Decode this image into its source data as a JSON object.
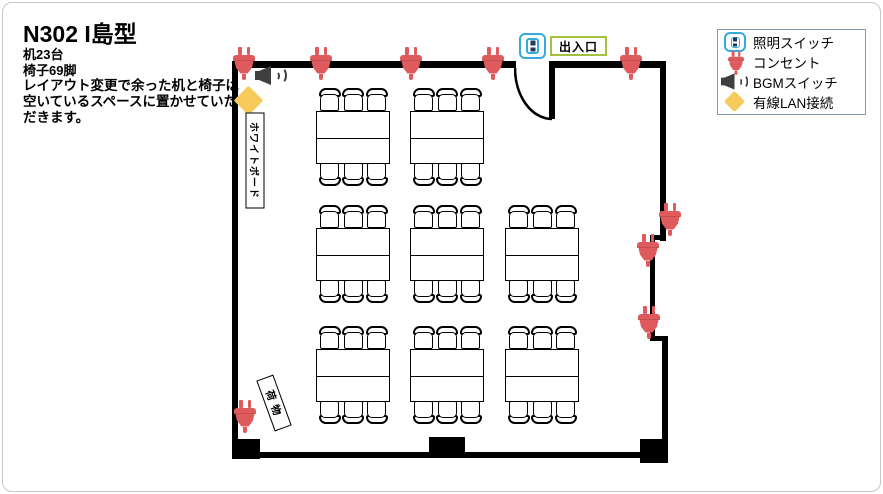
{
  "header": {
    "title": "N302  I島型",
    "desk_count": "机23台",
    "chair_count": "椅子69脚",
    "note_line1": "レイアウト変更で余った机と椅子は",
    "note_line2": "空いているスペースに置かせていた",
    "note_line3": "だきます。"
  },
  "legend": {
    "items": [
      {
        "icon": "light-switch-icon",
        "label": "照明スイッチ"
      },
      {
        "icon": "outlet-icon",
        "label": "コンセント"
      },
      {
        "icon": "bgm-speaker-icon",
        "label": "BGMスイッチ"
      },
      {
        "icon": "wired-lan-icon",
        "label": "有線LAN接続"
      }
    ]
  },
  "room": {
    "exit_label": "出入口",
    "whiteboard_label": "ホワイトボード",
    "luggage_label": "荷物"
  },
  "diagram": {
    "island_count": 8,
    "desks_per_island": 2,
    "chairs_per_island": 6
  },
  "colors": {
    "outlet_red": "#df5a5c",
    "switch_blue": "#35aadc",
    "exit_green": "#a3c13d",
    "lan_yellow": "#f6cb5c",
    "speaker_gray": "#3f3f3f",
    "wall_black": "#000000",
    "legend_border": "#7e9cb4"
  }
}
